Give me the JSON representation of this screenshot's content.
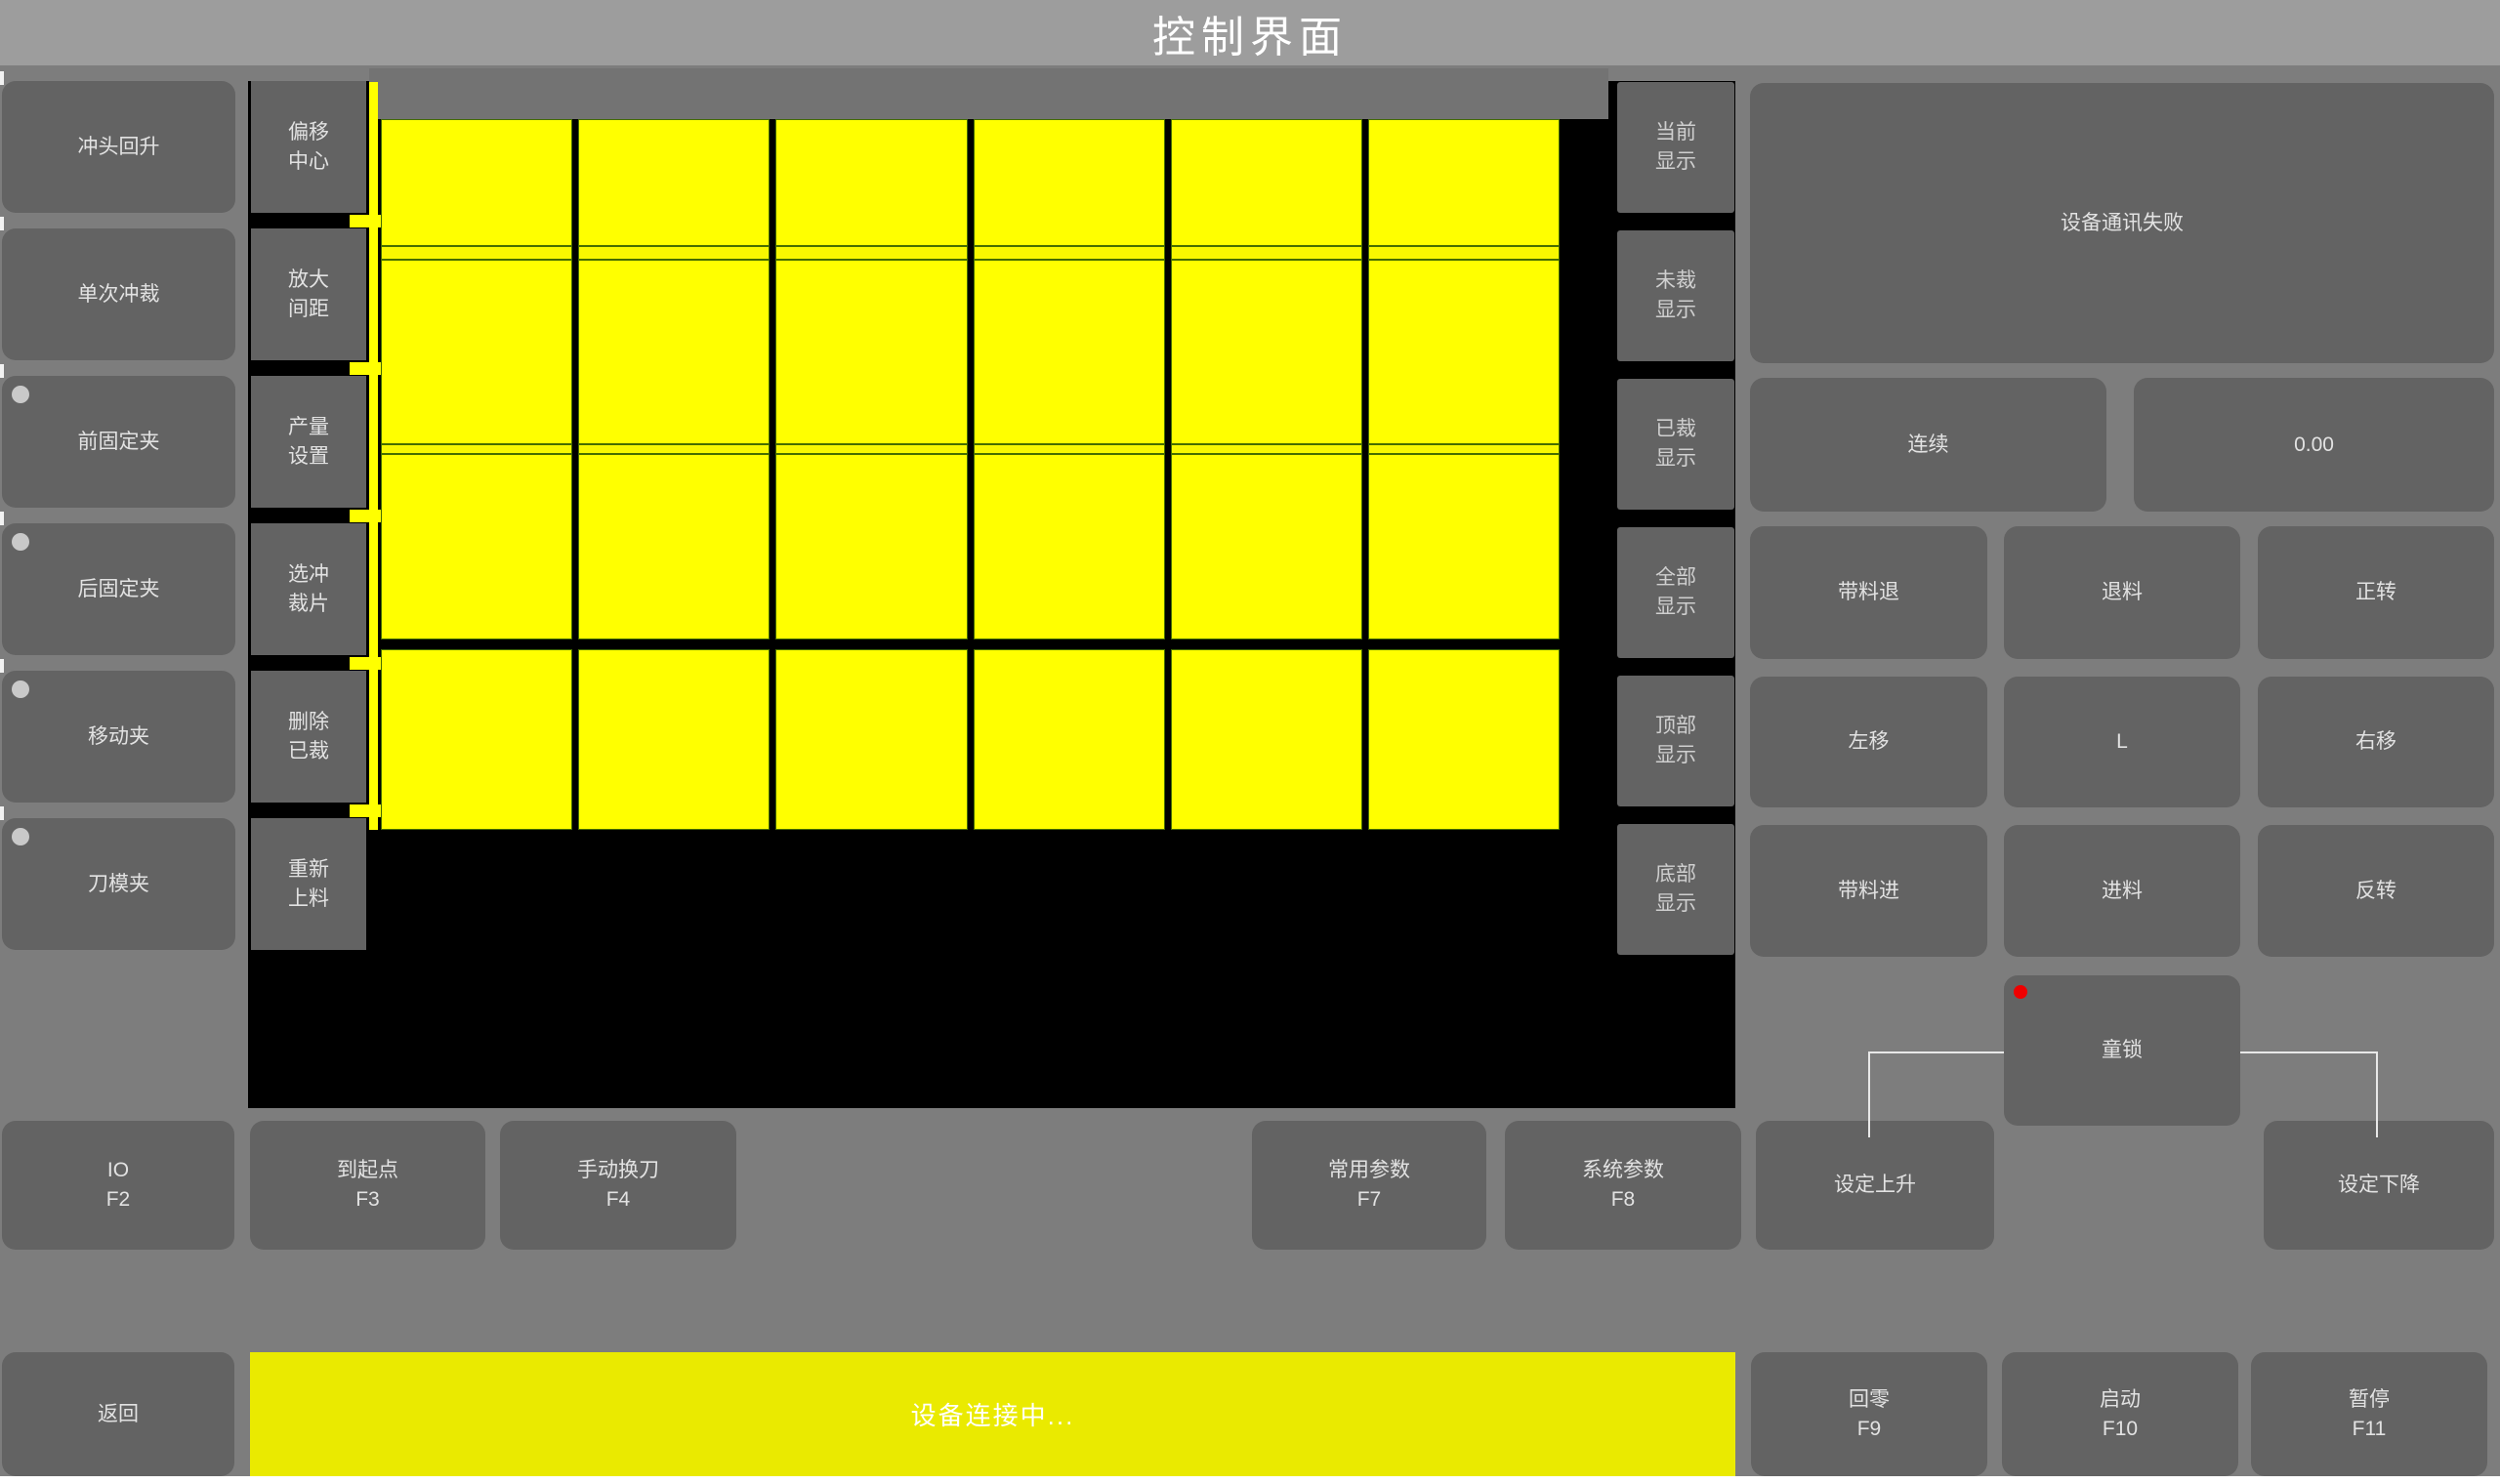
{
  "title": "控制界面",
  "left_buttons": [
    {
      "label": "冲头回升",
      "indicator": false
    },
    {
      "label": "单次冲裁",
      "indicator": false
    },
    {
      "label": "前固定夹",
      "indicator": true
    },
    {
      "label": "后固定夹",
      "indicator": true
    },
    {
      "label": "移动夹",
      "indicator": true
    },
    {
      "label": "刀模夹",
      "indicator": true
    }
  ],
  "mid_buttons": [
    {
      "label": "偏移中心",
      "lines": [
        "偏移",
        "中心"
      ]
    },
    {
      "label": "放大间距",
      "lines": [
        "放大",
        "间距"
      ]
    },
    {
      "label": "产量设置",
      "lines": [
        "产量",
        "设置"
      ]
    },
    {
      "label": "选冲裁片",
      "lines": [
        "选冲",
        "裁片"
      ]
    },
    {
      "label": "删除已裁",
      "lines": [
        "删除",
        "已裁"
      ]
    },
    {
      "label": "重新上料",
      "lines": [
        "重新",
        "上料"
      ]
    }
  ],
  "display_buttons": [
    {
      "label": "当前显示",
      "lines": [
        "当前",
        "显示"
      ]
    },
    {
      "label": "未裁显示",
      "lines": [
        "未裁",
        "显示"
      ]
    },
    {
      "label": "已裁显示",
      "lines": [
        "已裁",
        "显示"
      ]
    },
    {
      "label": "全部显示",
      "lines": [
        "全部",
        "显示"
      ]
    },
    {
      "label": "顶部显示",
      "lines": [
        "顶部",
        "显示"
      ]
    },
    {
      "label": "底部显示",
      "lines": [
        "底部",
        "显示"
      ]
    }
  ],
  "canvas": {
    "piece_columns": 6,
    "piece_rows": 4,
    "sheet_color": "#ffff00",
    "piece_outline_color": "#456d00",
    "background_color": "#000000"
  },
  "right_panel": {
    "status_message": "设备通讯失败",
    "mode_button": "连续",
    "value_display": "0.00",
    "jog_buttons": [
      [
        "带料退",
        "退料",
        "正转"
      ],
      [
        "左移",
        "L",
        "右移"
      ],
      [
        "带料进",
        "进料",
        "反转"
      ]
    ],
    "child_lock_button": "童锁",
    "child_lock_indicator_color": "#ee0000"
  },
  "function_row": [
    {
      "label": "IO",
      "fkey": "F2"
    },
    {
      "label": "到起点",
      "fkey": "F3"
    },
    {
      "label": "手动换刀",
      "fkey": "F4"
    },
    {
      "label": "常用参数",
      "fkey": "F7"
    },
    {
      "label": "系统参数",
      "fkey": "F8"
    },
    {
      "label": "设定上升",
      "fkey": ""
    },
    {
      "label": "设定下降",
      "fkey": ""
    }
  ],
  "bottom_bar": {
    "back_button": "返回",
    "status_message": "设备连接中...",
    "buttons": [
      {
        "label": "回零",
        "fkey": "F9"
      },
      {
        "label": "启动",
        "fkey": "F10"
      },
      {
        "label": "暂停",
        "fkey": "F11"
      }
    ]
  },
  "colors": {
    "accent_yellow": "#ffff00",
    "status_bar_yellow": "#eaea00",
    "alert_red": "#ee0000",
    "button_gray": "#636363",
    "titlebar_gray": "#9d9d9d"
  }
}
